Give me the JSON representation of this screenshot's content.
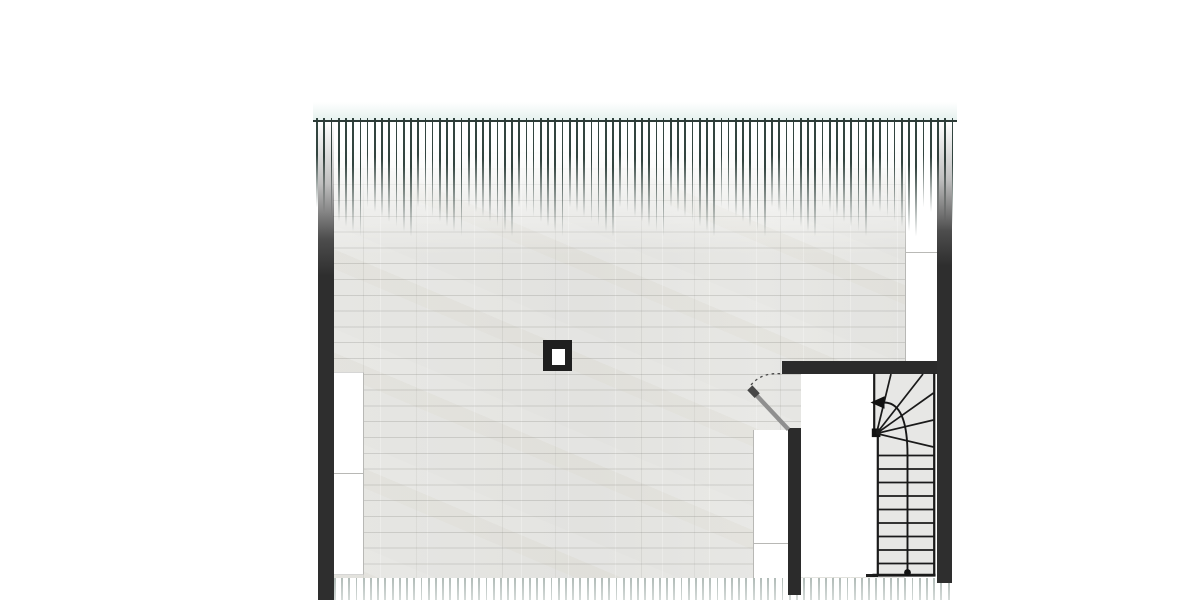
{
  "meta": {
    "kind": "architectural floor plan, attic storey",
    "visible_text": [],
    "features": [
      "wood plank floor",
      "eaves hatching top and bottom",
      "left exterior wall",
      "right exterior wall",
      "knee-wall strips",
      "chimney",
      "door with swing arc",
      "winder staircase with walk line arrow"
    ]
  },
  "colors": {
    "wall": "#2e2e2e",
    "wallstair": "#2b2b2b",
    "line": "#1a1a1a",
    "topline": "#2c3a36",
    "hatchtop": "#32443f",
    "hatchbottom": "rgba(105,125,118,0.52)",
    "floorbase": "#e4e4e2",
    "stairfill": "#e7e7e5",
    "stripedge": "#b8b8b5",
    "glow": "rgba(148,196,185,0.25)"
  },
  "hatches": [
    {
      "container": "hatch-top",
      "cls": "hl hl-top",
      "line_name": "eaves-hatch-line-top",
      "x_start": 316.2,
      "spacing": 7.22,
      "count": 89,
      "y": 117.5,
      "height_base": 92,
      "vary_mul": 29,
      "vary_mod": 7,
      "vary_step": 5
    },
    {
      "container": "hatch-bottom",
      "cls": "hl hl-bot",
      "line_name": "eaves-hatch-line-bottom",
      "x_start": 319.5,
      "spacing": 7.22,
      "count": 88,
      "y": 578,
      "height_base": 22,
      "vary_mul": 0,
      "vary_mod": 1,
      "vary_step": 0
    }
  ],
  "vectors": [
    {
      "t": "line",
      "name": "stair-left-border-upper",
      "a": {
        "x1": 874.2,
        "y1": 373.5,
        "x2": 874.2,
        "y2": 431.5,
        "stroke": "#1a1a1a",
        "stroke-width": 2.2
      }
    },
    {
      "t": "line",
      "name": "stair-left-border-lower",
      "a": {
        "x1": 877.8,
        "y1": 433,
        "x2": 877.8,
        "y2": 576,
        "stroke": "#1a1a1a",
        "stroke-width": 2.2
      }
    },
    {
      "t": "line",
      "name": "stair-right-border",
      "a": {
        "x1": 934.2,
        "y1": 373.5,
        "x2": 934.2,
        "y2": 576,
        "stroke": "#1a1a1a",
        "stroke-width": 2.2
      }
    },
    {
      "t": "line",
      "name": "stair-bottom-border",
      "a": {
        "x1": 872.5,
        "y1": 575.2,
        "x2": 935.5,
        "y2": 575.2,
        "stroke": "#1a1a1a",
        "stroke-width": 2.8
      }
    },
    {
      "t": "rect",
      "name": "stair-newel-post",
      "a": {
        "x": 871.8,
        "y": 428.5,
        "width": 8.6,
        "height": 8.6,
        "fill": "#121212"
      }
    },
    {
      "t": "line",
      "name": "winder-tread-1",
      "a": {
        "x1": 876.5,
        "y1": 433.5,
        "x2": 891,
        "y2": 374,
        "stroke": "#1a1a1a",
        "stroke-width": 1.7
      }
    },
    {
      "t": "line",
      "name": "winder-tread-2",
      "a": {
        "x1": 876.5,
        "y1": 433.5,
        "x2": 923,
        "y2": 374,
        "stroke": "#1a1a1a",
        "stroke-width": 1.7
      }
    },
    {
      "t": "line",
      "name": "winder-tread-3",
      "a": {
        "x1": 876.5,
        "y1": 433.5,
        "x2": 933.5,
        "y2": 393,
        "stroke": "#1a1a1a",
        "stroke-width": 1.7
      }
    },
    {
      "t": "line",
      "name": "winder-tread-4",
      "a": {
        "x1": 876.5,
        "y1": 433.5,
        "x2": 933.5,
        "y2": 420,
        "stroke": "#1a1a1a",
        "stroke-width": 1.7
      }
    },
    {
      "t": "line",
      "name": "winder-tread-5",
      "a": {
        "x1": 876.5,
        "y1": 433.5,
        "x2": 933.5,
        "y2": 447,
        "stroke": "#1a1a1a",
        "stroke-width": 1.7
      }
    },
    {
      "t": "line",
      "name": "straight-tread-1",
      "a": {
        "x1": 877.8,
        "y1": 455.5,
        "x2": 934.2,
        "y2": 455.5,
        "stroke": "#1a1a1a",
        "stroke-width": 1.7
      }
    },
    {
      "t": "line",
      "name": "straight-tread-2",
      "a": {
        "x1": 877.8,
        "y1": 469,
        "x2": 934.2,
        "y2": 469,
        "stroke": "#1a1a1a",
        "stroke-width": 1.7
      }
    },
    {
      "t": "line",
      "name": "straight-tread-3",
      "a": {
        "x1": 877.8,
        "y1": 482.5,
        "x2": 934.2,
        "y2": 482.5,
        "stroke": "#1a1a1a",
        "stroke-width": 1.7
      }
    },
    {
      "t": "line",
      "name": "straight-tread-4",
      "a": {
        "x1": 877.8,
        "y1": 496,
        "x2": 934.2,
        "y2": 496,
        "stroke": "#1a1a1a",
        "stroke-width": 1.7
      }
    },
    {
      "t": "line",
      "name": "straight-tread-5",
      "a": {
        "x1": 877.8,
        "y1": 509.5,
        "x2": 934.2,
        "y2": 509.5,
        "stroke": "#1a1a1a",
        "stroke-width": 1.7
      }
    },
    {
      "t": "line",
      "name": "straight-tread-6",
      "a": {
        "x1": 877.8,
        "y1": 523,
        "x2": 934.2,
        "y2": 523,
        "stroke": "#1a1a1a",
        "stroke-width": 1.7
      }
    },
    {
      "t": "line",
      "name": "straight-tread-7",
      "a": {
        "x1": 877.8,
        "y1": 536.5,
        "x2": 934.2,
        "y2": 536.5,
        "stroke": "#1a1a1a",
        "stroke-width": 1.7
      }
    },
    {
      "t": "line",
      "name": "straight-tread-8",
      "a": {
        "x1": 877.8,
        "y1": 550,
        "x2": 934.2,
        "y2": 550,
        "stroke": "#1a1a1a",
        "stroke-width": 1.7
      }
    },
    {
      "t": "line",
      "name": "straight-tread-9",
      "a": {
        "x1": 877.8,
        "y1": 563.5,
        "x2": 934.2,
        "y2": 563.5,
        "stroke": "#1a1a1a",
        "stroke-width": 1.7
      }
    },
    {
      "t": "path",
      "name": "stair-walk-line",
      "a": {
        "d": "M 907.5 573 L 907.5 455 Q 907.5 402.5 884 402.5",
        "stroke": "#161616",
        "stroke-width": 1.9,
        "fill": "none"
      }
    },
    {
      "t": "circle",
      "name": "walk-line-start-dot",
      "a": {
        "cx": 907.5,
        "cy": 572.5,
        "r": 3.4,
        "fill": "#111111"
      }
    },
    {
      "t": "polygon",
      "name": "walk-line-arrowhead",
      "a": {
        "points": "870.5,402.5 884.5,396.3 884.5,408.7",
        "fill": "#111111"
      }
    },
    {
      "t": "line",
      "name": "door-leaf",
      "a": {
        "x1": 788.5,
        "y1": 429.5,
        "x2": 752.5,
        "y2": 391,
        "stroke": "#8f8f8f",
        "stroke-width": 4.4
      }
    },
    {
      "t": "line",
      "name": "door-leaf-end-cap",
      "a": {
        "x1": 749.8,
        "y1": 387.8,
        "x2": 757.2,
        "y2": 395.6,
        "stroke": "#474747",
        "stroke-width": 7
      }
    },
    {
      "t": "path",
      "name": "door-swing-arc",
      "a": {
        "d": "M 751 385 Q 762 371.5 783.5 374",
        "stroke": "#4a4a4a",
        "stroke-width": 1.3,
        "fill": "none",
        "stroke-dasharray": "2.6 3.4"
      }
    }
  ]
}
